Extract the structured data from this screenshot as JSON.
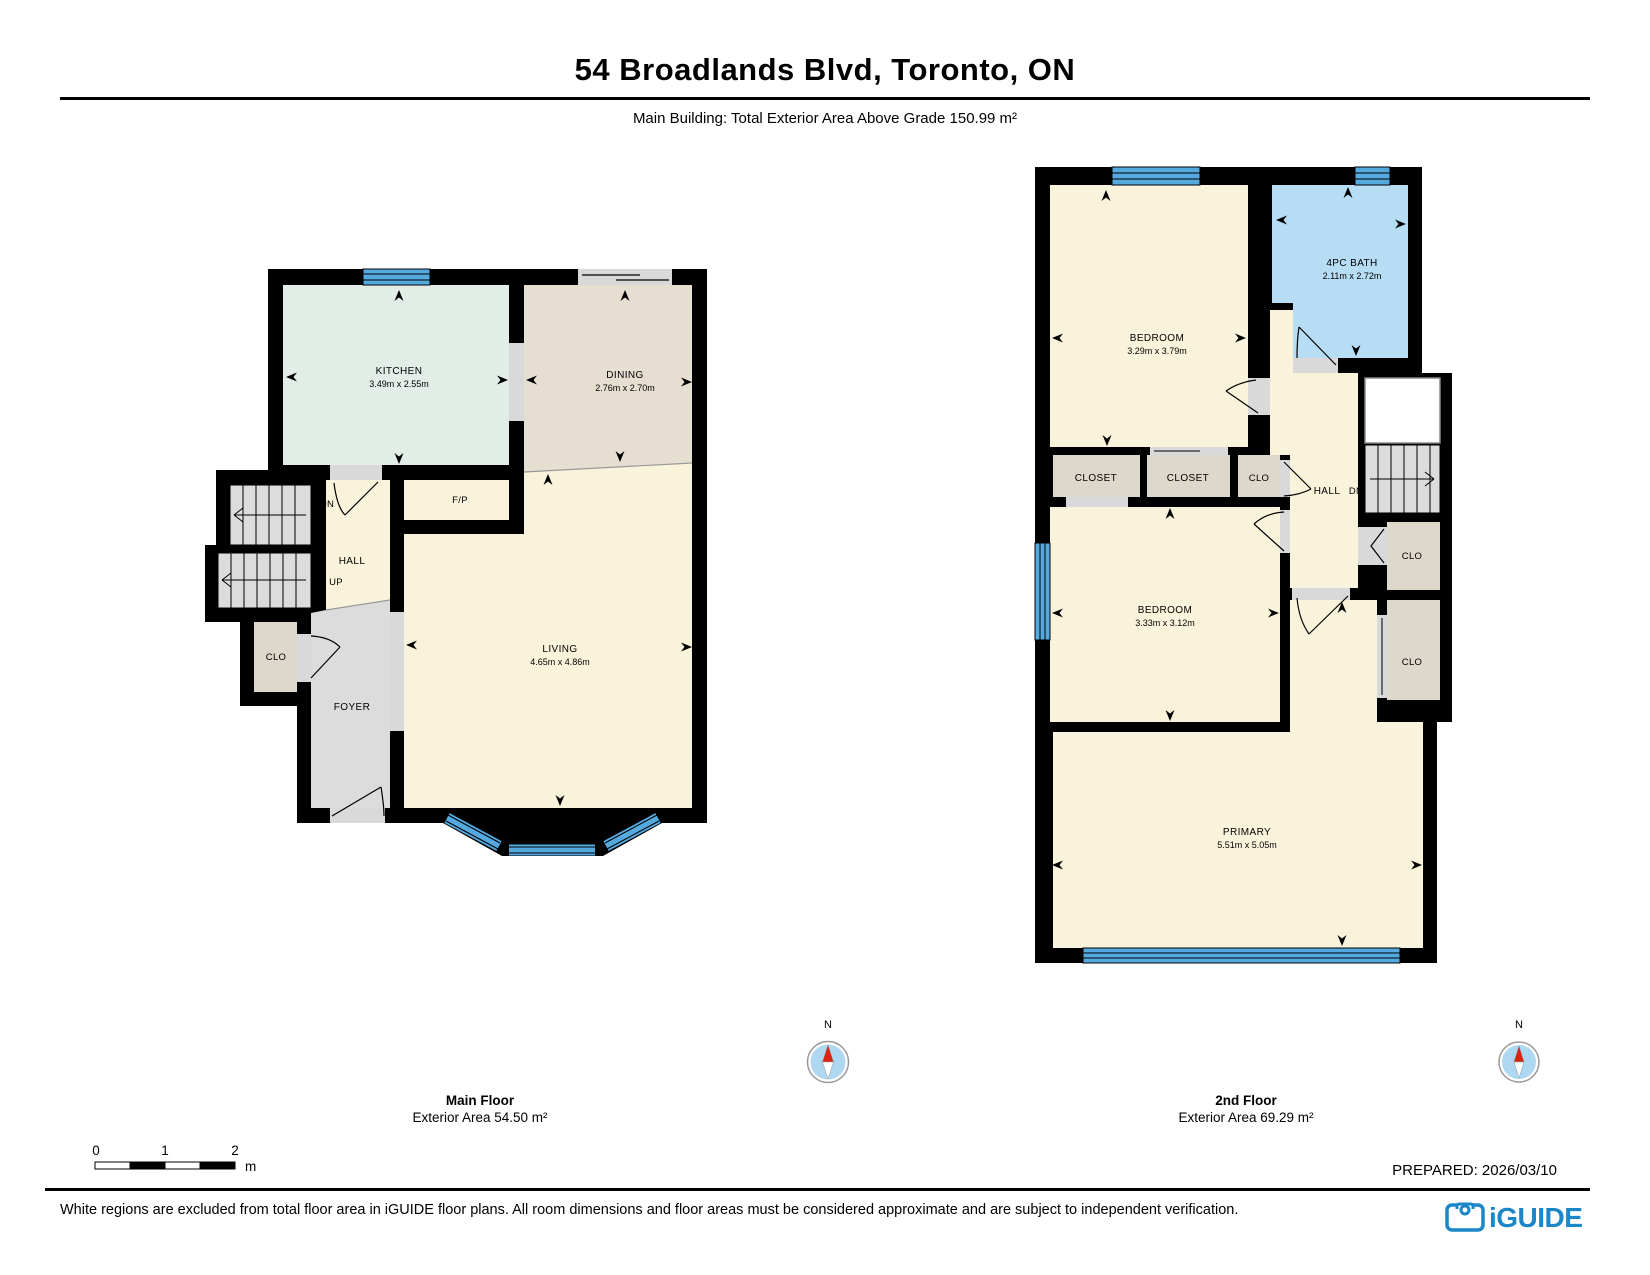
{
  "header": {
    "title": "54 Broadlands Blvd, Toronto, ON",
    "subtitle": "Main Building: Total Exterior Area Above Grade 150.99 m²"
  },
  "main_floor": {
    "name": "Main Floor",
    "area": "Exterior Area 54.50 m²",
    "labels": {
      "kitchen": "KITCHEN",
      "kitchen_dims": "3.49m x 2.55m",
      "dining": "DINING",
      "dining_dims": "2.76m x 2.70m",
      "living": "LIVING",
      "living_dims": "4.65m x 4.86m",
      "fp": "F/P",
      "hall": "HALL",
      "up": "UP",
      "dn": "DN",
      "clo": "CLO",
      "foyer": "FOYER"
    }
  },
  "second_floor": {
    "name": "2nd Floor",
    "area": "Exterior Area 69.29 m²",
    "labels": {
      "bedroom1": "BEDROOM",
      "bedroom1_dims": "3.29m x 3.79m",
      "bath": "4PC BATH",
      "bath_dims": "2.11m x 2.72m",
      "closet1": "CLOSET",
      "closet2": "CLOSET",
      "clo3": "CLO",
      "hall": "HALL",
      "dn": "DN",
      "clo_upper": "CLO",
      "clo_lower": "CLO",
      "bedroom2": "BEDROOM",
      "bedroom2_dims": "3.33m x 3.12m",
      "primary": "PRIMARY",
      "primary_dims": "5.51m x 5.05m"
    }
  },
  "compass": {
    "label": "N"
  },
  "scale_bar": {
    "t0": "0",
    "t1": "1",
    "t2": "2",
    "unit": "m"
  },
  "footer": {
    "prepared": "PREPARED: 2026/03/10",
    "disclaimer": "White regions are excluded from total floor area in iGUIDE floor plans. All room dimensions and floor areas must be considered approximate and are subject to independent verification.",
    "brand": "iGUIDE"
  },
  "colors": {
    "wall": "#000000",
    "room_cream": "#FAF3DC",
    "kitchen_mint": "#E3EDE7",
    "dining_tan": "#E6DED1",
    "closet_tan": "#DED7CB",
    "gray_floor": "#DCDCDC",
    "bath_blue": "#B6DDF4",
    "window_blue": "#54A9DF",
    "brand_blue": "#1B87C8"
  }
}
